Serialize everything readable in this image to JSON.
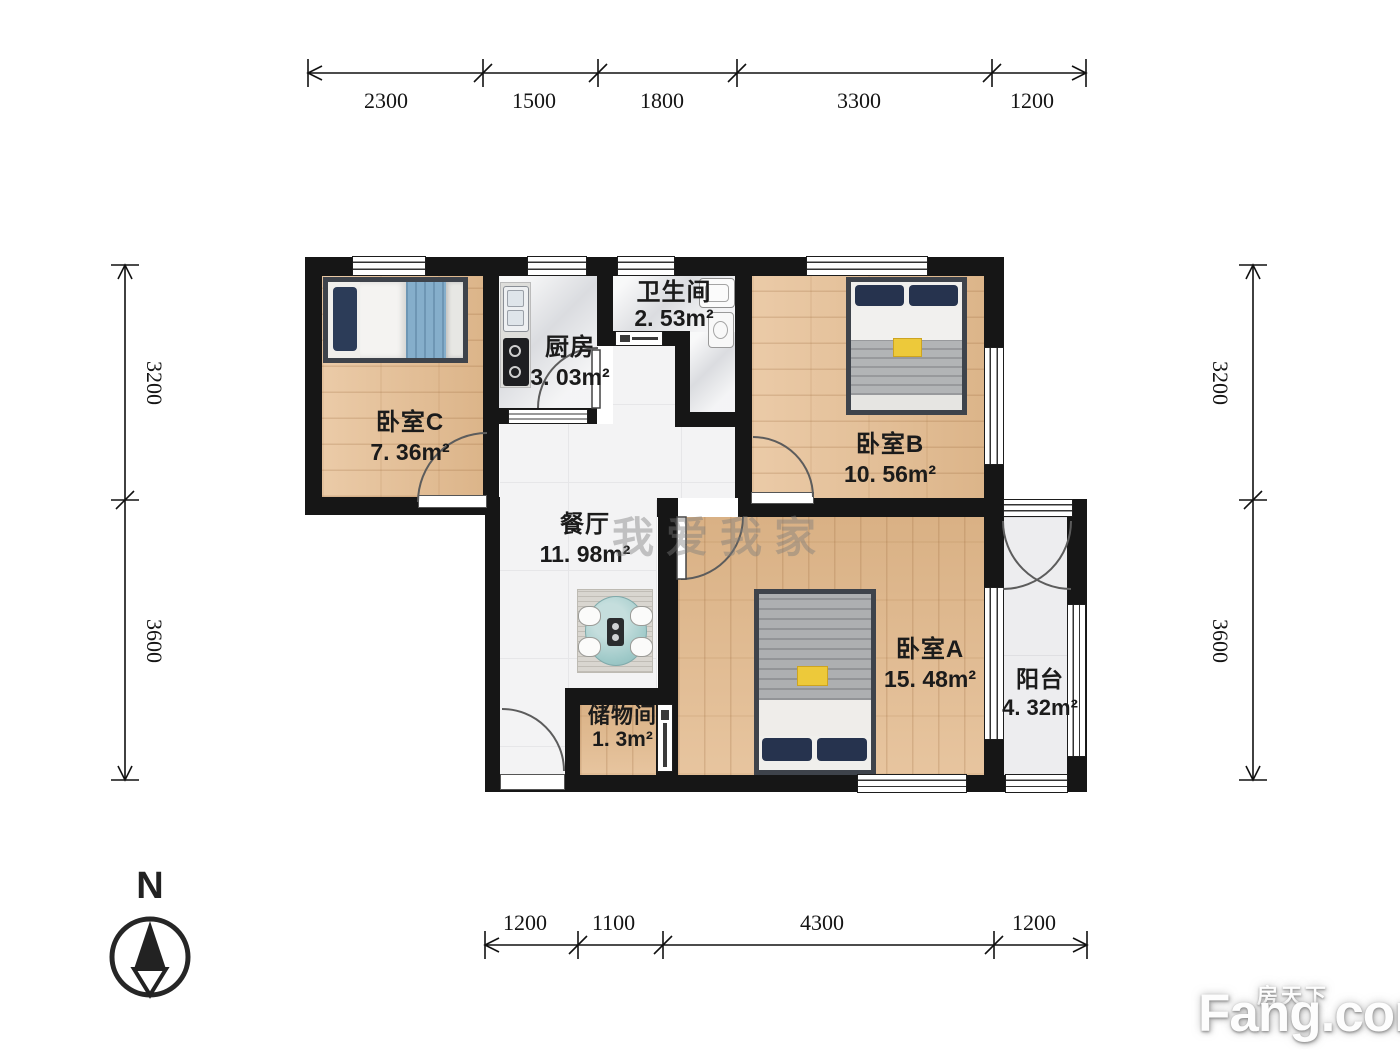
{
  "rooms": [
    {
      "id": "bedroom-c",
      "name": "卧室C",
      "area": "7. 36m²"
    },
    {
      "id": "kitchen",
      "name": "厨房",
      "area": "3. 03m²"
    },
    {
      "id": "bathroom",
      "name": "卫生间",
      "area": "2. 53m²"
    },
    {
      "id": "bedroom-b",
      "name": "卧室B",
      "area": "10. 56m²"
    },
    {
      "id": "dining",
      "name": "餐厅",
      "area": "11. 98m²"
    },
    {
      "id": "storage",
      "name": "储物间",
      "area": "1. 3m²"
    },
    {
      "id": "bedroom-a",
      "name": "卧室A",
      "area": "15. 48m²"
    },
    {
      "id": "balcony",
      "name": "阳台",
      "area": "4. 32m²"
    }
  ],
  "dimensions": {
    "top": [
      "2300",
      "1500",
      "1800",
      "3300",
      "1200"
    ],
    "bottom": [
      "1200",
      "1100",
      "4300",
      "1200"
    ],
    "left": [
      "3200",
      "3600"
    ],
    "right": [
      "3200",
      "3600"
    ]
  },
  "compass": {
    "north_label": "N"
  },
  "watermarks": {
    "plan_watermark": "我爱我家",
    "brand_cn": "房天下",
    "brand_en": "Fang.com"
  },
  "colors": {
    "wall": "#161616",
    "wood": "#e5bc8f",
    "tile": "#f3f3f4",
    "accent_blanket_blue": "#85aecb",
    "pillow_navy": "#26334e",
    "table_teal": "#9ec9c8",
    "highlight_yellow": "#edc93a"
  }
}
